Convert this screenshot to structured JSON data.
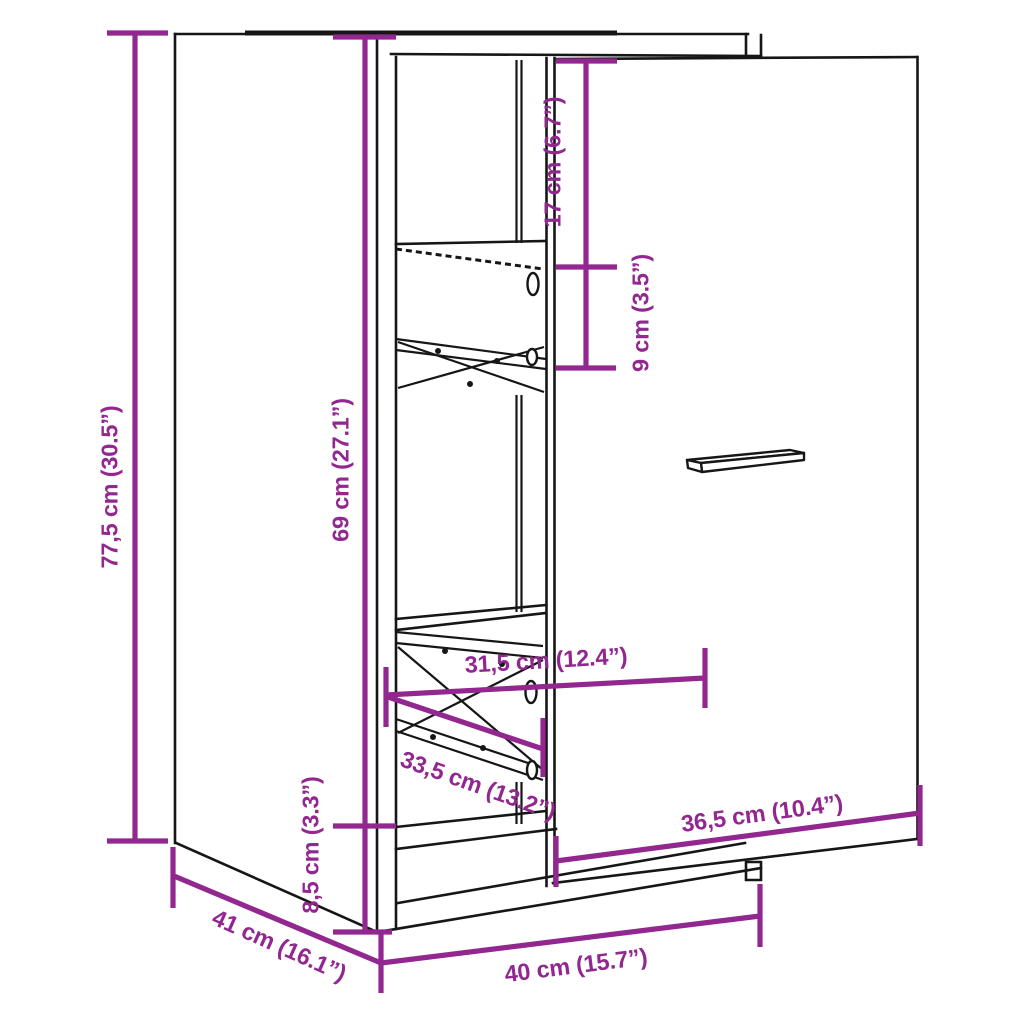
{
  "diagram": {
    "type": "product-dimension-line-drawing",
    "subject": "apothecary cabinet with pull-out basket drawer and open door",
    "colors": {
      "dimension": "#92278f",
      "line": "#161616",
      "background": "#ffffff"
    },
    "labels": {
      "total_height": "77,5 cm (30.5”)",
      "interior_height": "69 cm (27.1”)",
      "top_clearance": "17 cm (6.7”)",
      "basket_height": "9 cm (3.5”)",
      "pullout_width": "31,5 cm (12.4”)",
      "basket_depth": "33,5 cm (13.2”)",
      "door_width": "36,5 cm (10.4”)",
      "plinth_height": "8,5 cm (3.3”)",
      "depth": "41 cm (16.1”)",
      "width": "40 cm (15.7”)"
    }
  }
}
